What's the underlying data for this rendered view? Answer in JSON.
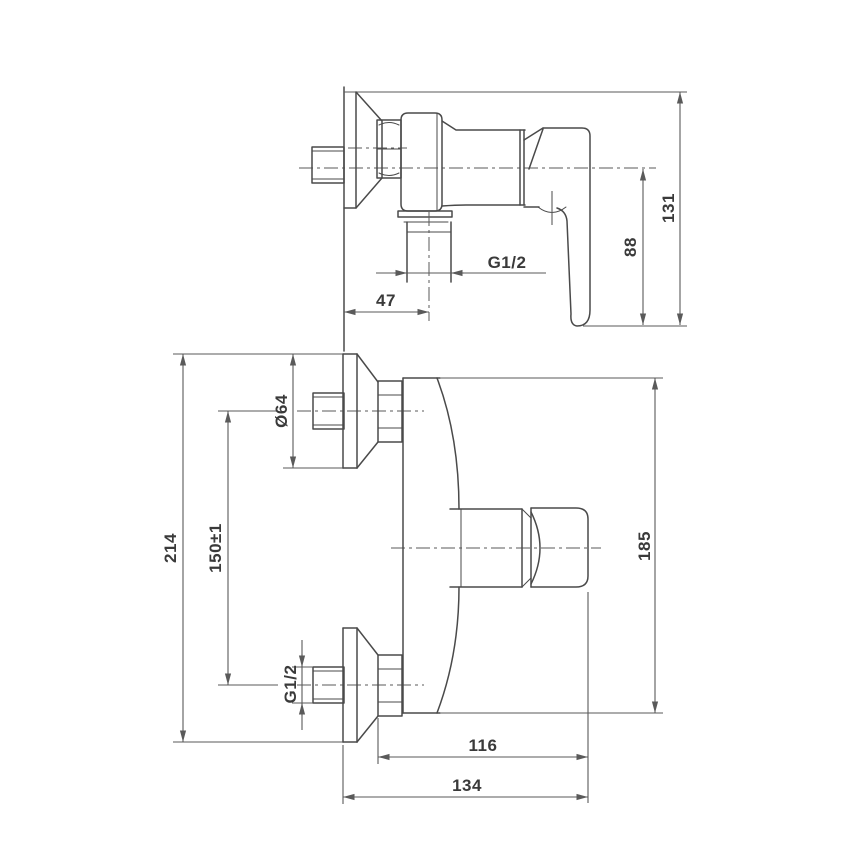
{
  "style": {
    "colors": {
      "bg": "#ffffff",
      "line": "#4a4a4a",
      "dim": "#5a5a5a",
      "text": "#3a3a3a"
    }
  },
  "drawing": {
    "type": "technical-dimensional-drawing",
    "side_view": {
      "dims": {
        "wall_offset": "47",
        "outlet_thread": "G1/2",
        "axis_to_bottom": "88",
        "overall": "131"
      }
    },
    "front_view": {
      "dims": {
        "overall_height": "214",
        "centers": "150±1",
        "escutcheon_dia": "Ø64",
        "inlet_thread": "G1/2",
        "body_height": "185",
        "depth_inner": "116",
        "depth_overall": "134"
      }
    }
  }
}
